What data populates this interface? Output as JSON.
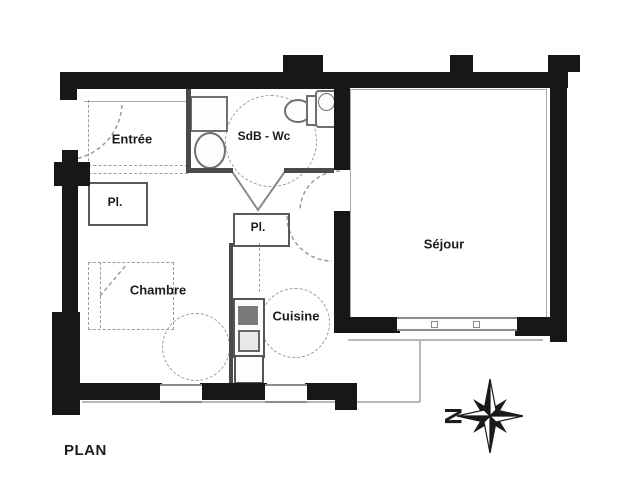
{
  "page": {
    "title_label": "PLAN"
  },
  "rooms": {
    "entree": "Entrée",
    "sdb": "SdB - Wc",
    "closet1": "Pl.",
    "closet2": "Pl.",
    "chambre": "Chambre",
    "cuisine": "Cuisine",
    "sejour": "Séjour"
  },
  "compass": {
    "north": "N"
  },
  "colors": {
    "wall": "#171717",
    "thin_wall": "#4a4a4a",
    "fixture": "#6f6f6f",
    "dashed": "#9c9c9c",
    "window_frame": "#8c8c8c",
    "terrace": "#b8b8b8",
    "text": "#1c1c1c",
    "background": "#ffffff"
  }
}
